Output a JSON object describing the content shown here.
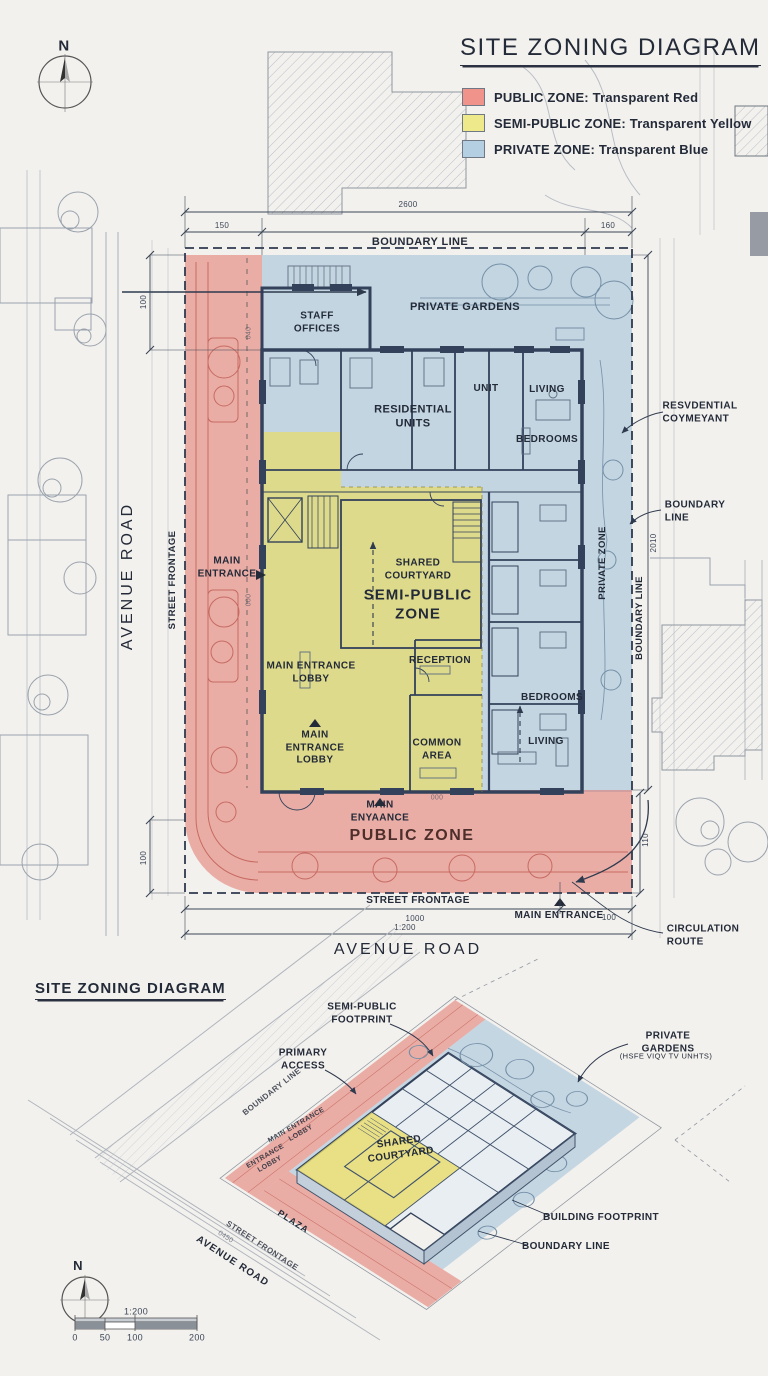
{
  "colors": {
    "public_red": "#e0695e",
    "semi_public_yellow": "#e8dc6a",
    "private_blue": "#8fb6d4",
    "ink": "#232a38",
    "legend_red": "#f0938b",
    "legend_yellow": "#eee98a",
    "legend_blue": "#b5cfe2"
  },
  "header": {
    "title": "SITE ZONING DIAGRAM",
    "legend": [
      {
        "label": "PUBLIC ZONE: Transparent Red",
        "swatch": "#f0938b"
      },
      {
        "label": "SEMI-PUBLIC ZONE: Transparent Yellow",
        "swatch": "#eee98a"
      },
      {
        "label": "PRIVATE ZONE: Transparent Blue",
        "swatch": "#b5cfe2"
      }
    ]
  },
  "compass": {
    "north": "N"
  },
  "plan": {
    "boundary_line_top": "BOUNDARY LINE",
    "staff_offices": "STAFF\nOFFICES",
    "private_gardens": "PRIVATE GARDENS",
    "residential_units": "RESIDENTIAL\nUNITS",
    "unit": "UNIT",
    "living_upper": "LIVING",
    "bedrooms_upper": "BEDROOMS",
    "main_entrance_left": "MAIN\nENTRANCE",
    "shared_courtyard": "SHARED\nCOURTYARD",
    "semi_public_zone": "SEMI-PUBLIC\nZONE",
    "reception": "RECEPTION",
    "main_entrance_lobby": "MAIN ENTRANCE\nLOBBY",
    "bedrooms_lower": "BEDROOMS",
    "living_lower": "LIVING",
    "common_area": "COMMON\nAREA",
    "main_entrance_lobby_red": "MAIN\nENTRANCE\nLOBBY",
    "main_entrance_mid": "MAIN\nENYAANCE",
    "public_zone": "PUBLIC ZONE",
    "street_frontage_bottom": "STREET FRONTAGE",
    "main_entrance_bottom": "MAIN ENTRANCE",
    "circulation_route": "CIRCULATION\nROUTE",
    "avenue_road_bottom": "AVENUE ROAD",
    "avenue_road_left": "AVENUE ROAD",
    "street_frontage_left": "STREET FRONTAGE",
    "residential_covenant": "RESVDENTIAL\nCOYMEYANT",
    "boundary_line_right": "BOUNDARY\nLINE",
    "boundary_line_vert": "BOUNDARY LINE",
    "private_zone_vert": "PRIVATE ZONE",
    "dims": {
      "top_total": "2600",
      "top_left": "150",
      "top_right": "160",
      "left_upper": "100",
      "left_lower": "100",
      "right_upper": "2010",
      "right_lower": "110",
      "bottom_main": "1000",
      "bottom_scale": "1:200",
      "bottom_right": "100",
      "small_a": "040",
      "small_b": "000",
      "small_c": "000"
    }
  },
  "axon": {
    "title": "SITE ZONING DIAGRAM",
    "semi_public_footprint": "SEMI-PUBLIC\nFOOTPRINT",
    "primary_access": "PRIMARY\nACCESS",
    "private_gardens": "PRIVATE GARDENS",
    "private_gardens_sub": "(HSFE VIQV TV UNHTS)",
    "building_footprint": "BUILDING FOOTPRINT",
    "boundary_line": "BOUNDARY LINE",
    "shared_courtyard": "SHARED\nCOURTYARD",
    "main_entrance_lobby": "MAIN ENTRANCE\nLOBBY",
    "entrance_lobby": "ENTRANCE\nLOBBY",
    "boundary_line_diag": "BOUNDARY LINE",
    "plaza": "PLAZA",
    "street_frontage": "STREET FRONTAGE",
    "avenue_road": "AVENUE ROAD",
    "dim_small": "0450",
    "compass": "N",
    "scale": {
      "ratio": "1:200",
      "t0": "0",
      "t50": "50",
      "t100": "100",
      "t200": "200"
    }
  }
}
